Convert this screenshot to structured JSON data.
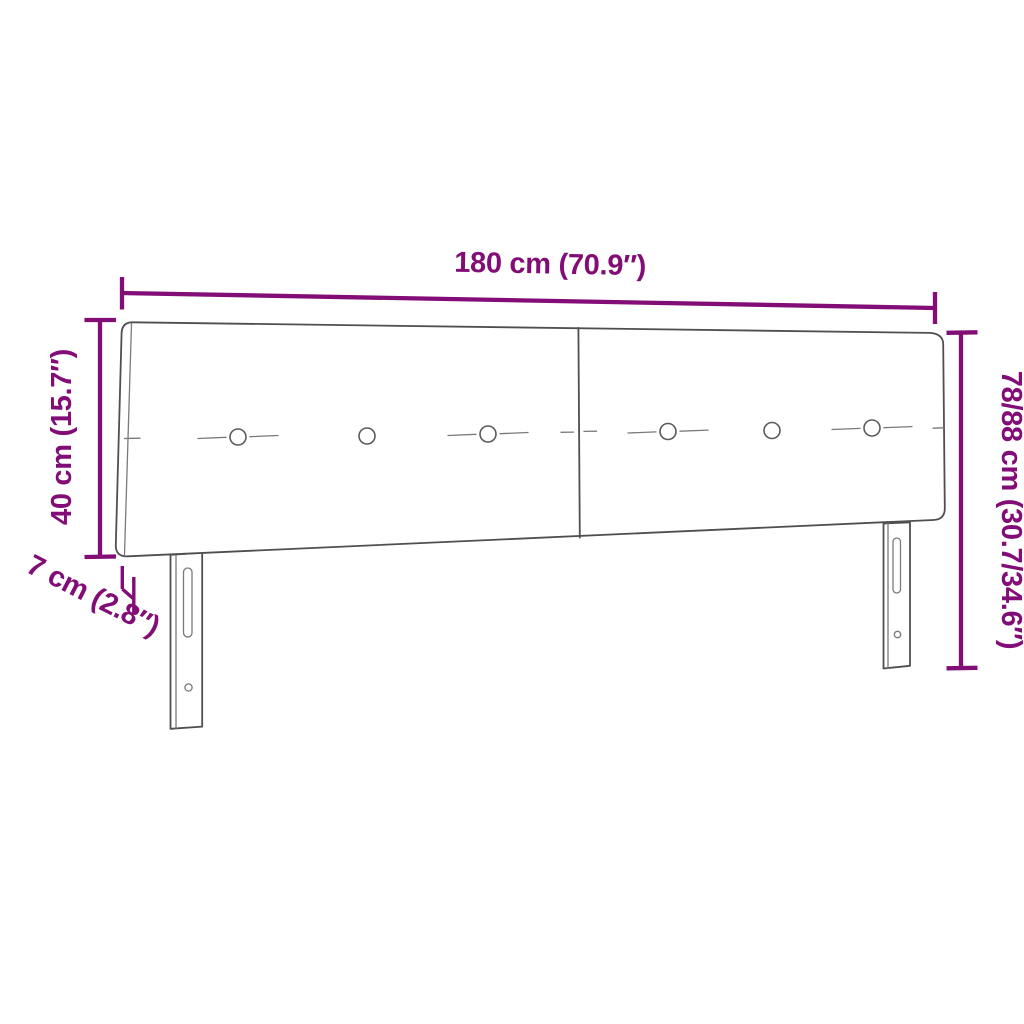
{
  "diagram": {
    "subject": "headboard",
    "annotation_color": "#820d76",
    "outline_color": "#4f4f4f",
    "dimensions": {
      "width": {
        "label": "180 cm (70.9″)",
        "cm": "180",
        "inches": "70.9"
      },
      "panel_height": {
        "label": "40 cm (15.7″)",
        "cm": "40",
        "inches": "15.7"
      },
      "panel_thickness": {
        "label": "7 cm (2.8″)",
        "cm": "7",
        "inches": "2.8"
      },
      "total_height": {
        "label": "78/88 cm (30.7/34.6″)",
        "cm": "78/88",
        "inches": "30.7/34.6"
      }
    }
  }
}
